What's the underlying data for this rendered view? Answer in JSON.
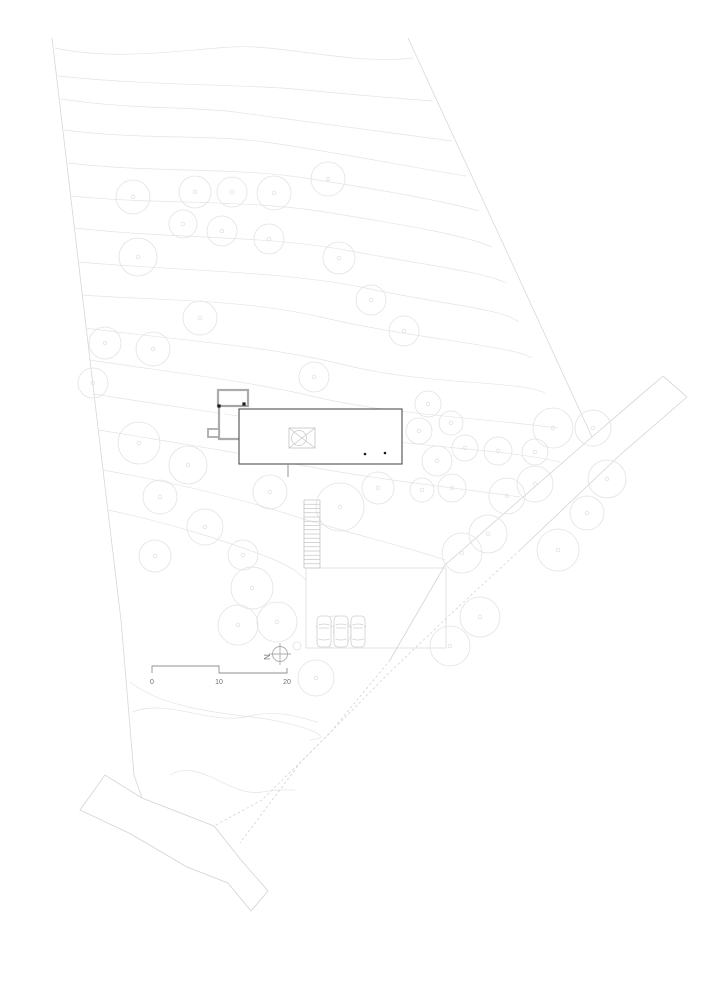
{
  "meta": {
    "title": "Architectural site plan with contours, trees, house, stair, parking terrace, scale bar and north arrow"
  },
  "colors": {
    "background": "#ffffff",
    "contour": "#e4e4e4",
    "tree": "#e2e2e2",
    "boundary": "#d7d7d7",
    "road": "#d3d3d3",
    "terrace": "#dcdcdc",
    "building_dark": "#4f4f4f",
    "annex_gray": "#ababab",
    "detail_light": "#c4c4c4",
    "car": "#d0d0d0",
    "scale_bar": "#8f8f8f",
    "label_text": "#707070",
    "dot_black": "#1a1a1a"
  },
  "drawing": {
    "boundaries": [
      {
        "name": "left-property-line",
        "d": "M52,38 L77,250 L103,470 L121,620 L134,775 L142,798"
      },
      {
        "name": "right-property-line",
        "d": "M408,38 L506,250 L592,437"
      }
    ],
    "contours": [
      "M55,48 C130,64 210,44 255,47 C305,50 360,64 413,58",
      "M58,76 C150,86 250,84 305,90 C355,95 395,98 433,101",
      "M61,99 C135,110 185,106 235,112 C310,122 390,133 452,141",
      "M64,130 C140,140 205,134 265,142 C335,152 415,168 466,176",
      "M68,163 C150,173 235,167 305,178 C375,189 440,200 479,211",
      "M71,196 C160,205 245,199 325,212 C405,225 465,235 492,247",
      "M75,228 C170,239 265,235 345,250 C425,265 485,272 506,283",
      "M78,262 C180,271 285,271 365,288 C445,305 500,308 519,322",
      "M82,295 C165,301 245,299 325,318 C415,339 510,345 532,358",
      "M86,328 C180,341 265,345 345,365 C430,386 520,380 545,393",
      "M90,360 C175,373 250,381 320,398 C390,414 480,418 558,428",
      "M94,394 C180,408 260,418 330,432 C405,447 500,448 560,462",
      "M99,430 C170,442 230,451 290,463 C370,479 450,487 520,497",
      "M103,470 C170,482 240,498 300,518 C360,536 410,548 445,560",
      "M108,510 C165,522 225,540 275,560 C293,568 300,574 306,580",
      "M130,682 C160,706 210,712 260,718 C300,724 340,738 310,740",
      "M132,712 C170,698 210,726 250,716 C280,709 300,718 318,722",
      "M170,775 C200,757 230,798 262,792 C278,789 288,790 295,790"
    ],
    "roads": [
      {
        "name": "driveway-upper-edge",
        "d": "M663,376 L592,437 L445,565 L390,660",
        "dashed": false
      },
      {
        "name": "driveway-upper-edge-dashed",
        "d": "M390,660 L330,733 L262,800 L214,826",
        "dashed": true
      },
      {
        "name": "driveway-lower-edge",
        "d": "M687,397 L620,455 L520,550",
        "dashed": false
      },
      {
        "name": "driveway-lower-edge-dashed",
        "d": "M520,550 L455,610 L390,672 L300,763 L240,843",
        "dashed": true
      },
      {
        "name": "driveway-top-cap",
        "d": "M663,376 L687,397",
        "dashed": false
      },
      {
        "name": "lower-road-outline",
        "d": "M80,810 L105,775 L142,798 L214,826 L241,860 L268,891 L251,911 L228,883 L187,867 L129,833 Z",
        "dashed": false
      }
    ],
    "trees": [
      [
        133,
        197,
        17
      ],
      [
        195,
        192,
        16
      ],
      [
        232,
        192,
        15
      ],
      [
        274,
        193,
        17
      ],
      [
        328,
        179,
        17
      ],
      [
        183,
        224,
        14
      ],
      [
        222,
        231,
        15
      ],
      [
        269,
        239,
        15
      ],
      [
        138,
        257,
        19
      ],
      [
        339,
        258,
        16
      ],
      [
        371,
        300,
        15
      ],
      [
        404,
        331,
        15
      ],
      [
        200,
        318,
        17
      ],
      [
        105,
        343,
        16
      ],
      [
        153,
        349,
        17
      ],
      [
        93,
        383,
        15
      ],
      [
        314,
        377,
        15
      ],
      [
        428,
        404,
        13
      ],
      [
        451,
        423,
        12
      ],
      [
        419,
        431,
        13
      ],
      [
        465,
        448,
        13
      ],
      [
        437,
        461,
        15
      ],
      [
        498,
        451,
        14
      ],
      [
        535,
        452,
        13
      ],
      [
        553,
        428,
        20
      ],
      [
        593,
        428,
        18
      ],
      [
        607,
        479,
        19
      ],
      [
        422,
        490,
        12
      ],
      [
        452,
        488,
        14
      ],
      [
        507,
        496,
        18
      ],
      [
        535,
        484,
        18
      ],
      [
        587,
        513,
        17
      ],
      [
        488,
        534,
        19
      ],
      [
        462,
        553,
        20
      ],
      [
        558,
        550,
        21
      ],
      [
        480,
        617,
        20
      ],
      [
        450,
        646,
        20
      ],
      [
        139,
        443,
        21
      ],
      [
        188,
        465,
        19
      ],
      [
        160,
        497,
        17
      ],
      [
        205,
        527,
        18
      ],
      [
        155,
        556,
        16
      ],
      [
        243,
        555,
        15
      ],
      [
        270,
        492,
        17
      ],
      [
        340,
        507,
        24
      ],
      [
        378,
        488,
        16
      ],
      [
        252,
        588,
        21
      ],
      [
        238,
        625,
        20
      ],
      [
        277,
        622,
        20
      ],
      [
        316,
        678,
        18
      ],
      [
        335,
        632,
        16
      ],
      [
        297,
        646,
        4
      ]
    ],
    "tree_trunk_radius": 1.8,
    "terrace": {
      "rect": [
        306,
        568,
        140,
        80
      ]
    },
    "building": {
      "main_rect": [
        239,
        409,
        163,
        55
      ],
      "annex_rect": [
        218,
        390,
        30,
        16
      ],
      "annex_wall_path": "M219,406 L219,439 L240,439",
      "notch_rect": [
        208,
        429,
        11,
        8
      ],
      "divider_line": [
        219,
        406,
        248,
        406
      ],
      "corner_dots": [
        [
          219,
          406
        ],
        [
          244,
          404
        ]
      ],
      "skylight_rect": [
        289,
        428,
        26,
        20
      ],
      "skylight_diagonals": [
        "M289,428 L315,448",
        "M315,428 L289,448"
      ],
      "skylight_circle": [
        299,
        438,
        7.5
      ],
      "interior_dots": [
        [
          365,
          454
        ],
        [
          385,
          453
        ]
      ],
      "door_line": [
        288,
        464,
        288,
        477
      ]
    },
    "stairs": {
      "x1": 304,
      "x2": 320,
      "y_top": 500,
      "y_bottom": 568,
      "steps": 16
    },
    "cars": {
      "positions": [
        [
          317,
          616
        ],
        [
          334,
          616
        ],
        [
          351,
          616
        ]
      ],
      "width": 14,
      "height": 31
    }
  },
  "scale_bar": {
    "path": "M152,673 L152,666 L219,666 L219,673 L287,673 L287,668",
    "labels": [
      {
        "text": "0",
        "x": 152
      },
      {
        "text": "10",
        "x": 219
      },
      {
        "text": "20",
        "x": 287
      }
    ],
    "label_y": 684,
    "font_size": 7
  },
  "north_arrow": {
    "label": "N",
    "circle": [
      280,
      654,
      7.5
    ],
    "h_line": [
      269,
      654,
      291,
      654
    ],
    "v_line": [
      280,
      643,
      280,
      665
    ],
    "label_x": 264,
    "label_y": 657,
    "rotation": 90,
    "font_size": 8
  }
}
